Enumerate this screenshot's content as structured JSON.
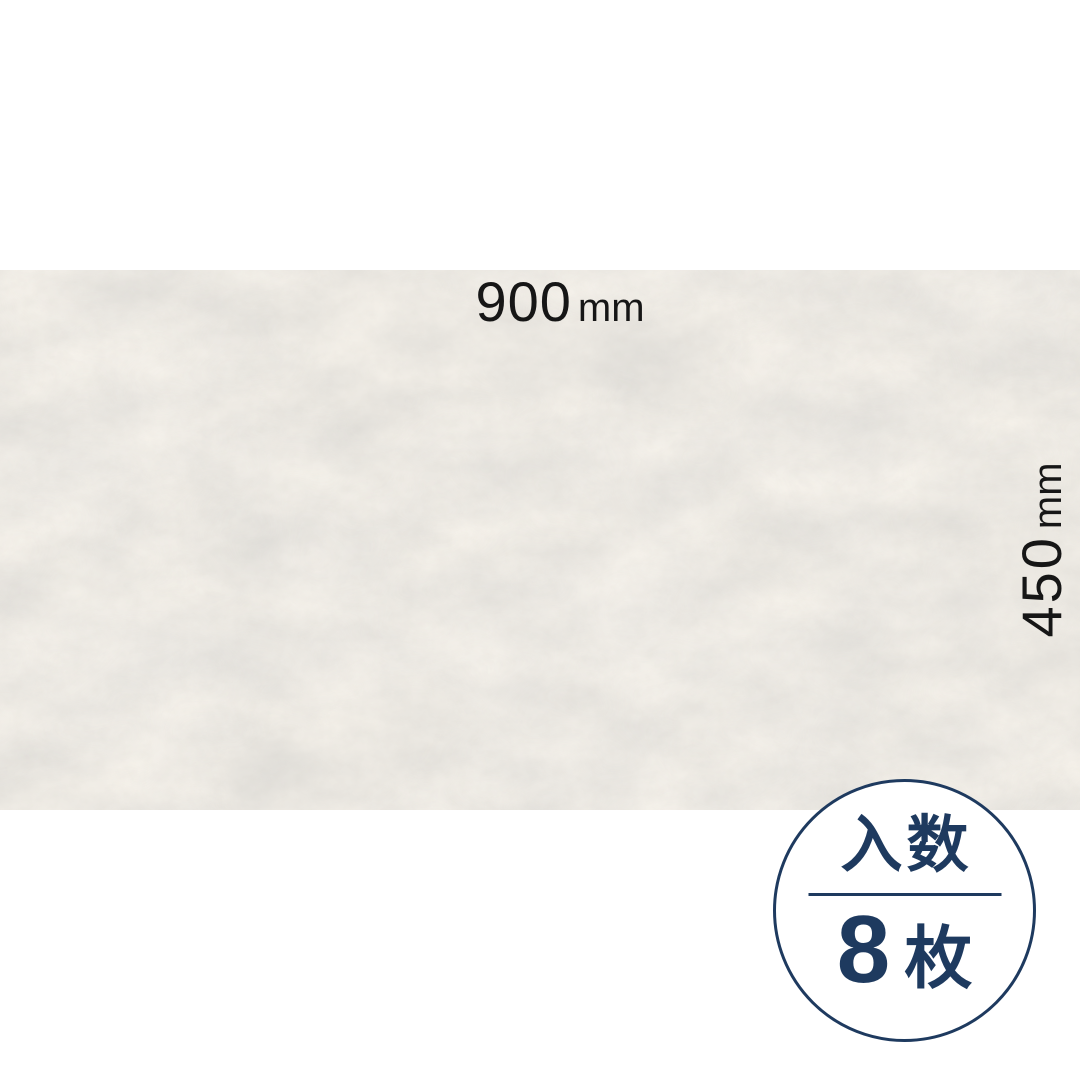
{
  "product_image": {
    "description_role": "tile-panel-dimension-spec",
    "panel": {
      "kind": "stone-texture-panel"
    },
    "dimensions": {
      "width": {
        "value": "900",
        "unit": "mm"
      },
      "height": {
        "value": "450",
        "unit": "mm"
      }
    },
    "badge": {
      "title": "入数",
      "count": "8",
      "unit": "枚"
    },
    "colors": {
      "background": "#ffffff",
      "dimension_text": "#161616",
      "badge_navy": "#1e3a5f",
      "tile_base": "#d5cfc6",
      "tile_light_patch": "#e0dbd3",
      "tile_dark_patch": "#c5beb2"
    }
  }
}
